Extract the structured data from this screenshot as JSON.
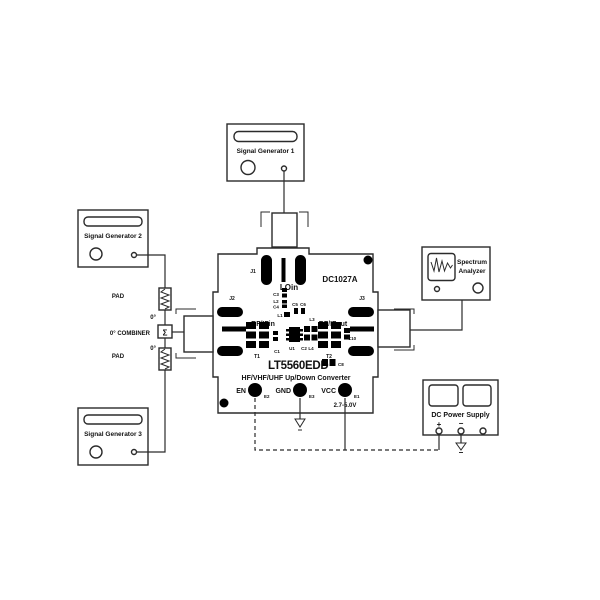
{
  "instruments": {
    "sg1": {
      "label": "Signal Generator 1"
    },
    "sg2": {
      "label": "Signal Generator 2"
    },
    "sg3": {
      "label": "Signal Generator 3"
    },
    "spectrum_analyzer": {
      "line1": "Spectrum",
      "line2": "Analyzer"
    },
    "dc_supply": {
      "label": "DC Power Supply",
      "plus": "+",
      "minus": "−"
    }
  },
  "combiner_chain": {
    "pad_top": "PAD",
    "deg_top": "0°",
    "combiner_label": "0° COMBINER",
    "sigma": "Σ",
    "deg_bottom": "0°",
    "pad_bottom": "PAD"
  },
  "board": {
    "model": "DC1027A",
    "part": "LT5560EDD",
    "description": "HF/VHF/UHF Up/Down Converter",
    "lo_in": "LOin",
    "rf_if_in": "RF/IFin",
    "rf_if_out": "RF/IFout",
    "connectors": {
      "j1": "J1",
      "j2": "J2",
      "j3": "J3"
    },
    "transformers": {
      "t1": "T1",
      "t2": "T2"
    },
    "ic": "U1",
    "refs": {
      "c1": "C1",
      "c2": "C2",
      "c3": "C3",
      "c4": "C4",
      "c5": "C5",
      "c6": "C6",
      "c8": "C8",
      "c10": "C10",
      "l1": "L1",
      "l2": "L2",
      "l3": "L3",
      "l4": "L4"
    },
    "terminals": {
      "en": "EN",
      "gnd": "GND",
      "vcc": "VCC",
      "e1": "E1",
      "e2": "E2",
      "e3": "E3",
      "vcc_range": "2.7-5.0V"
    }
  },
  "colors": {
    "line": "#2b2b2b",
    "component": "#000000",
    "background": "#ffffff"
  }
}
